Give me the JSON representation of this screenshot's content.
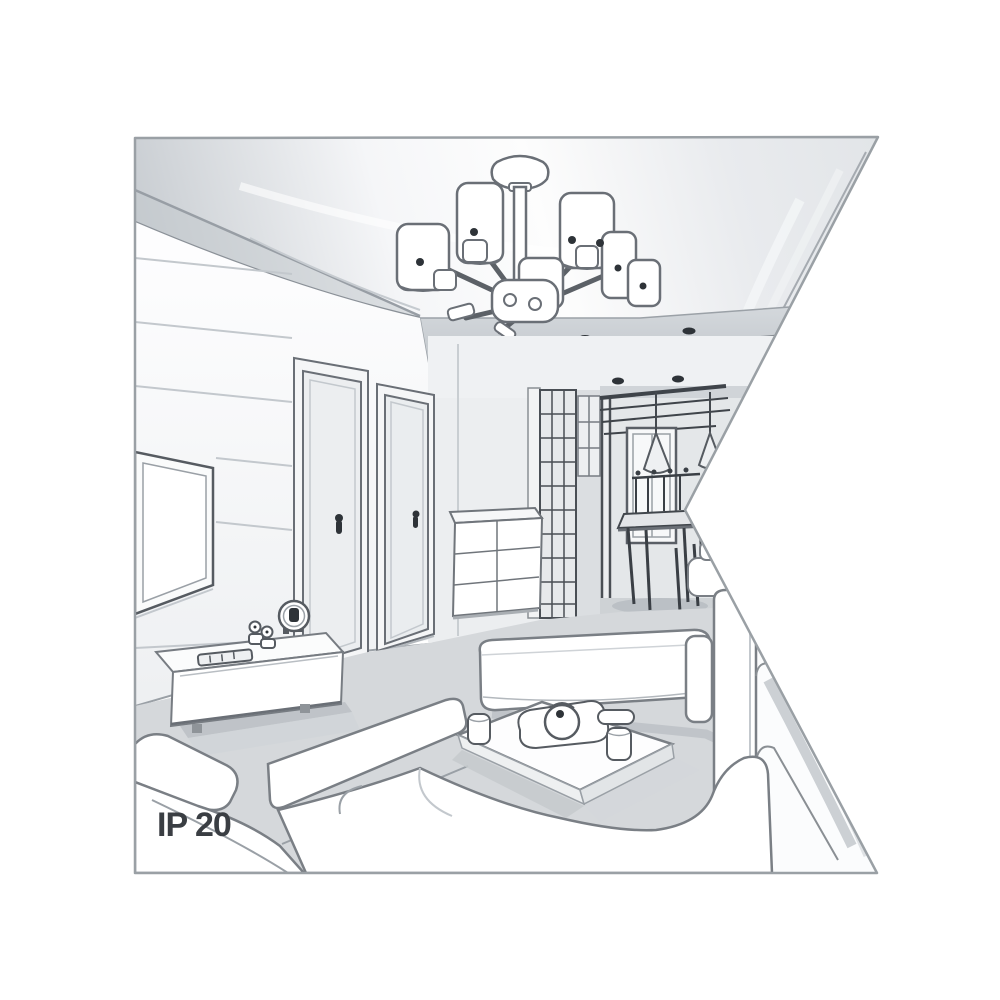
{
  "scene": {
    "rating_label": "IP 20",
    "colors": {
      "background": "#ffffff",
      "border": "#9aa0a5",
      "outline": "#6a6f76",
      "outline_soft": "#9aa0a6",
      "outline_dark": "#41464c",
      "ceiling_shade": "#c3c8cd",
      "wall_shade": "#eef0f2",
      "floor_shade": "#d5d8db",
      "label_text": "#3a3e43"
    }
  }
}
